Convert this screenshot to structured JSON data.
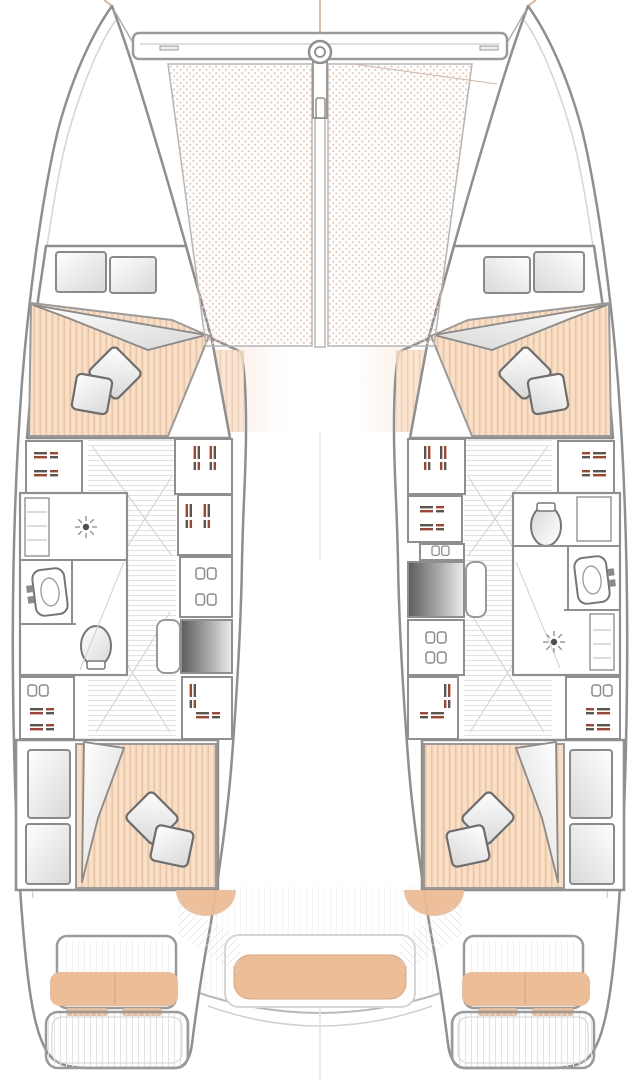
{
  "diagram": {
    "kind": "catamaran-floor-plan-top-view",
    "hull_count": 2,
    "double_berth_count": 4,
    "bathroom_count": 2,
    "trampoline_panel_count": 2,
    "pillows_per_berth": 2,
    "stern_cushion_count": 5
  },
  "icons": {
    "shower_head": "radial-dashes",
    "toilet": "ellipse-with-tank",
    "sink": "rounded-basin-with-faucet",
    "drawer_pulls": "bracket-pair",
    "locker_label": "tiny-dash-marks",
    "beam_fitting": "concentric-circles"
  },
  "palette": {
    "paper": "#ffffff",
    "outline": "#8f8f8f",
    "outline_soft": "#c9c9c9",
    "wall": "#767676",
    "mattress_base": "#f8dfc8",
    "mattress_stripe": "#edc5a1",
    "net_dot": "#eecab4",
    "cushion": "#ecbd96",
    "cushion_edge": "#dca377",
    "fade_band": "#f2d6bf",
    "stairs_dark": "#5c5c5c",
    "stairs_mid": "#a9a9a9",
    "stairs_light": "#ededed",
    "floor_line": "#e2e2e2",
    "label_red": "#a5432c",
    "label_gray": "#5c544e",
    "rig_line": "#e8a77e"
  }
}
